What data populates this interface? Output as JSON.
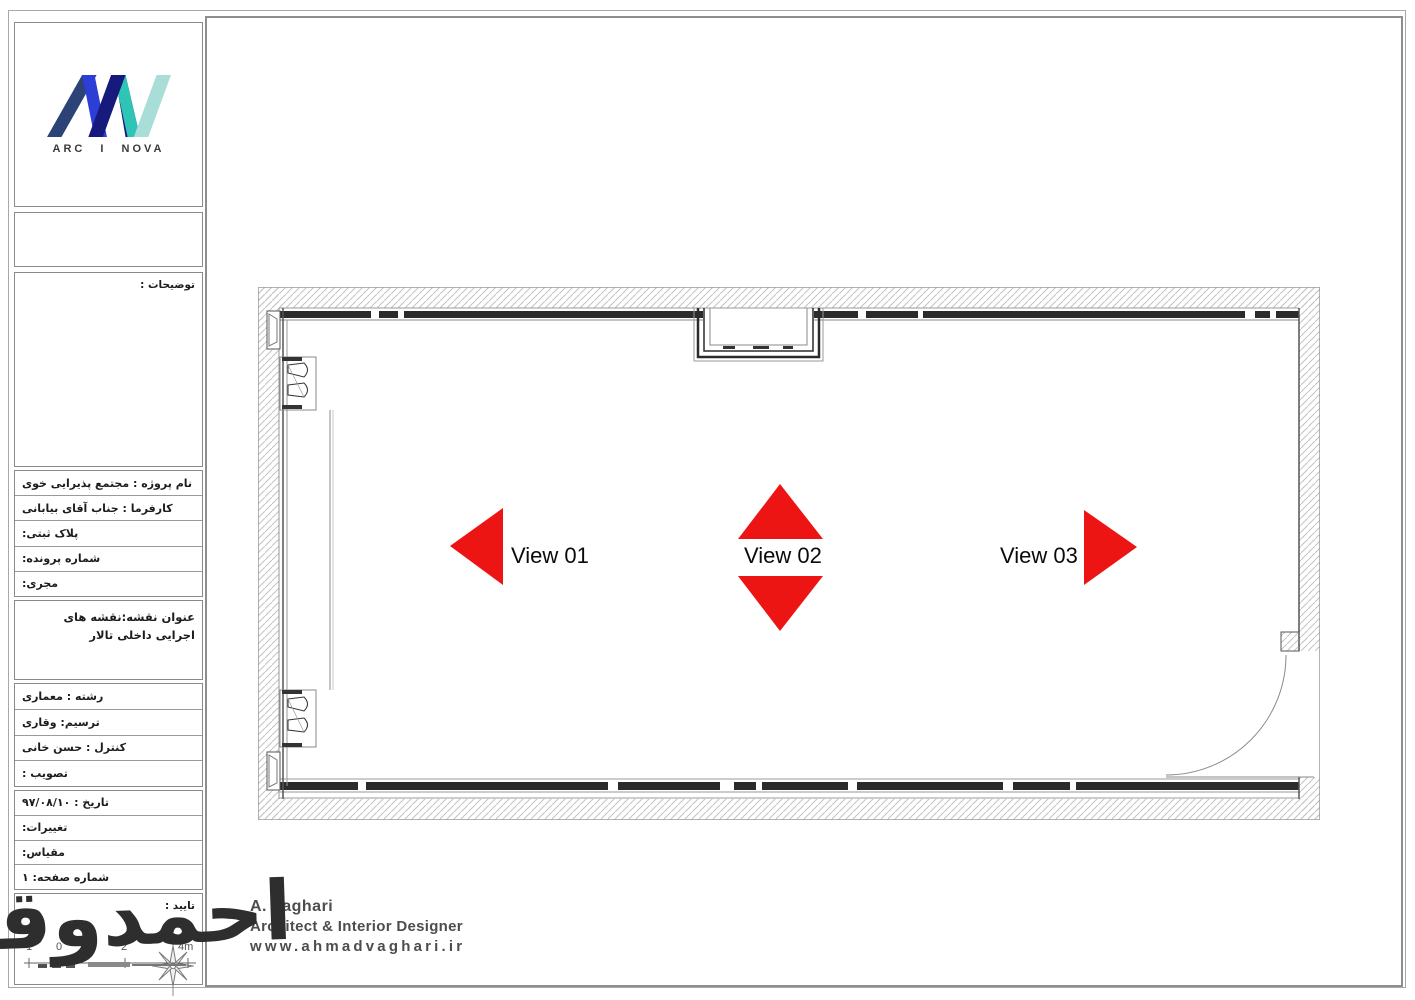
{
  "logo": {
    "brand": "ARC I NOVA"
  },
  "title_block": {
    "notes_label": "توضیحات :",
    "project_rows": [
      "نام پروژه : مجتمع پذیرایی خوی",
      "کارفرما : جناب آقای بیابانی",
      "پلاک ثبتی:",
      "شماره پرونده:",
      "مجری:"
    ],
    "drawing_title": "عنوان نقشه:نقشه های اجرایی داخلی تالار",
    "personnel_rows": [
      "رشته : معماری",
      "ترسیم: وقاری",
      "کنترل : حسن خانی",
      "تصویب :"
    ],
    "date_rows": [
      "تاریخ : ۹۷/۰۸/۱۰",
      "تغییرات:",
      "مقیاس:",
      "شماره صفحه: ۱"
    ],
    "approval_label": "تایید :"
  },
  "plan": {
    "views": [
      {
        "label": "View 01",
        "direction": "left"
      },
      {
        "label": "View 02",
        "direction": "up-down"
      },
      {
        "label": "View 03",
        "direction": "right"
      }
    ],
    "arrow_color": "#ed1414"
  },
  "scale_bar": {
    "labels": [
      "1",
      "0",
      "2",
      "4m"
    ]
  },
  "signature": {
    "text": "احمدوقاری"
  },
  "footer": {
    "name": "A. Vaghari",
    "title": "Architect & Interior Designer",
    "website": "www.ahmadvaghari.ir"
  },
  "colors": {
    "arrow_red": "#ed1414",
    "wall_dark": "#2b2b2b",
    "hatch_gray": "#c3c3c3",
    "logo_navy": "#2c4377",
    "logo_deep_blue": "#161a7d",
    "logo_blue": "#2c3ed6",
    "logo_teal": "#2ec4b6",
    "logo_light_teal": "#a9ded8"
  }
}
